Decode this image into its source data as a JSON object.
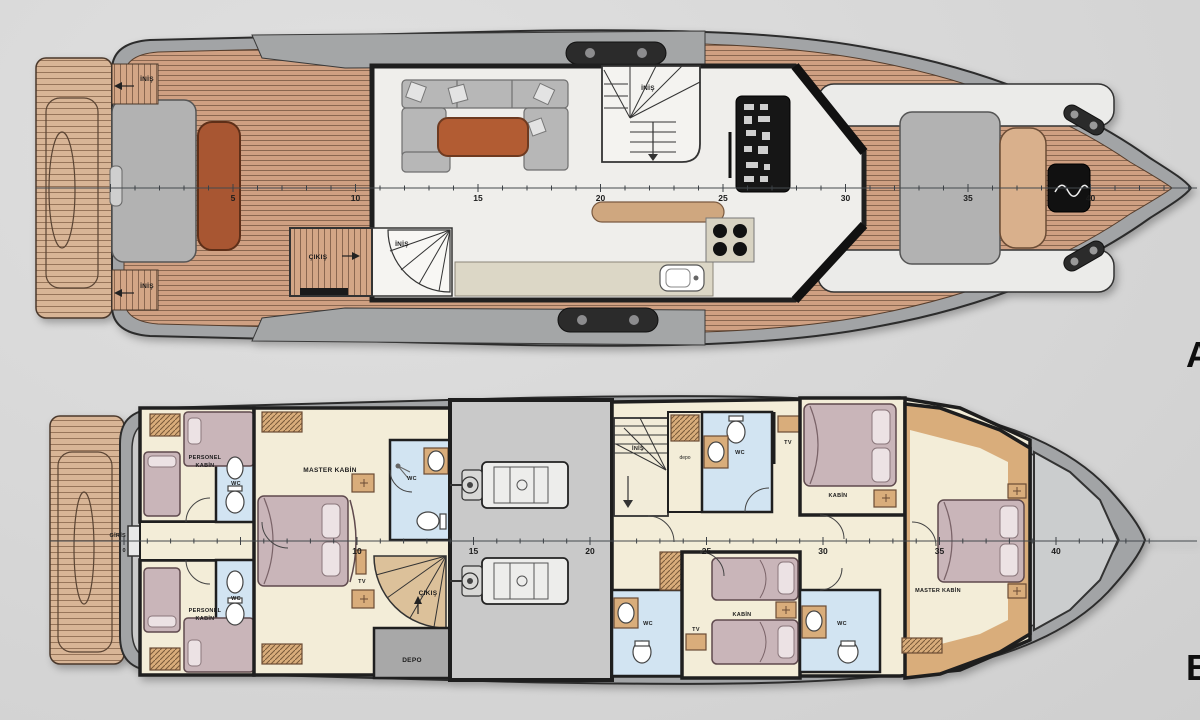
{
  "colors": {
    "background": "#d8d8d8",
    "hull_gray": "#a2a4a6",
    "teak": "#cfa082",
    "teak_stripe": "#8a6750",
    "platform_teak": "#d8b596",
    "salon_floor": "#efeeeb",
    "sofa_gray": "#b7b7b7",
    "table_rust": "#b25c33",
    "counter_beige": "#dcd7c6",
    "console_black": "#161616",
    "cabin_floor_cream": "#f3edd8",
    "furniture_tan": "#d9ad7b",
    "bed_mauve": "#c9b5b9",
    "wc_blue": "#d2e4f2",
    "engine_room_gray": "#c7c7c7",
    "wall_dark": "#222222"
  },
  "deck_a": {
    "letter": "A",
    "labels": {
      "inis_side_top": "İNİŞ",
      "inis_side_bottom": "İNİŞ",
      "cikis_door": "ÇIKIŞ",
      "inis_curved_stairs": "İNİŞ",
      "inis_helm_stairs": "İNİŞ"
    },
    "stations": [
      "5",
      "10",
      "15",
      "20",
      "25",
      "30",
      "35",
      "40"
    ]
  },
  "deck_b": {
    "letter": "B",
    "labels": {
      "giris": "GİRİŞ",
      "personel_top_1": "PERSONEL",
      "personel_top_2": "KABİN",
      "personel_bottom_1": "PERSONEL",
      "personel_bottom_2": "KABİN",
      "wc_crew_top": "WC",
      "wc_crew_bottom": "WC",
      "master_mid": "MASTER KABİN",
      "wc_master": "WC",
      "tv_master": "TV",
      "cikis_stairs": "ÇIKIŞ",
      "depo_main": "DEPO",
      "inis_stairs": "İNİŞ",
      "depo_closet": "depo",
      "wc_guest_top": "WC",
      "tv_guest_top": "TV",
      "kabin_guest_top": "KABİN",
      "wc_guest_mid": "WC",
      "tv_guest_bottom": "TV",
      "kabin_guest_bottom": "KABİN",
      "wc_guest_bottom": "WC",
      "master_bow": "MASTER KABİN"
    },
    "station_zero": "0",
    "stations": [
      "10",
      "15",
      "20",
      "25",
      "30",
      "35",
      "40"
    ]
  }
}
